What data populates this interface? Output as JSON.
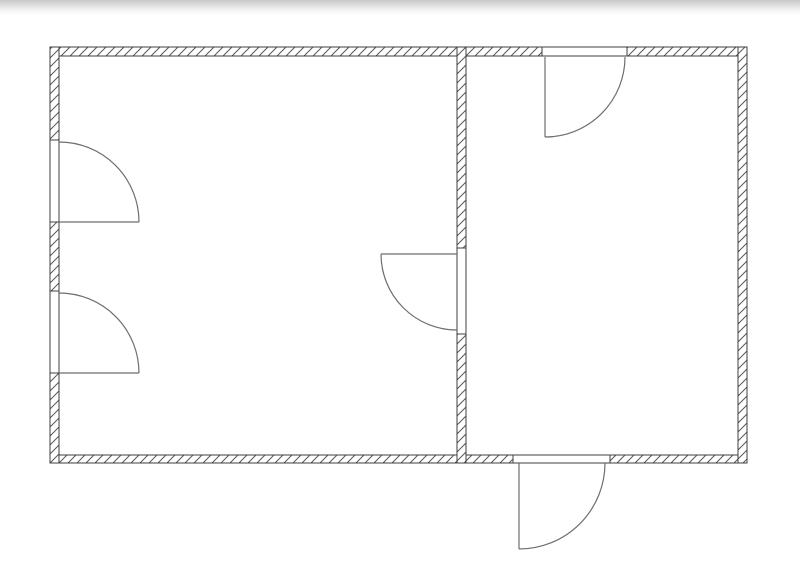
{
  "page": {
    "background": "#ffffff",
    "top_shade": {
      "from": "#c7c7c7",
      "to": "#ffffff",
      "height": 15
    }
  },
  "floorplan": {
    "canvas": {
      "width": 800,
      "height": 574
    },
    "colors": {
      "wall_stroke": "#3f3f3f",
      "hatch_stroke": "#585858",
      "door_stroke": "#6e6e6e",
      "wall_fill": "#ffffff",
      "opening_fill": "#ffffff"
    },
    "hatch": {
      "spacing": 9,
      "stroke_width": 1
    },
    "walls": [
      {
        "name": "wall-top",
        "x": 50,
        "y": 47,
        "w": 697,
        "h": 9
      },
      {
        "name": "wall-bottom",
        "x": 50,
        "y": 455,
        "w": 697,
        "h": 8
      },
      {
        "name": "wall-left",
        "x": 50,
        "y": 47,
        "w": 9,
        "h": 416
      },
      {
        "name": "wall-right",
        "x": 738,
        "y": 47,
        "w": 9,
        "h": 416
      },
      {
        "name": "wall-interior",
        "x": 457,
        "y": 47,
        "w": 9,
        "h": 416
      }
    ],
    "openings": [
      {
        "name": "opening-left-upper",
        "x": 50,
        "y": 140,
        "w": 9,
        "h": 82
      },
      {
        "name": "opening-left-lower",
        "x": 50,
        "y": 291,
        "w": 9,
        "h": 82
      },
      {
        "name": "opening-interior",
        "x": 457,
        "y": 248,
        "w": 9,
        "h": 86
      },
      {
        "name": "opening-top",
        "x": 542,
        "y": 47,
        "w": 85,
        "h": 9
      },
      {
        "name": "opening-bottom",
        "x": 513,
        "y": 455,
        "w": 97,
        "h": 8
      }
    ],
    "doors": [
      {
        "name": "door-left-upper",
        "leaf": {
          "x1": 59,
          "y1": 222,
          "x2": 139,
          "y2": 222
        },
        "arc": {
          "sx": 59,
          "sy": 142,
          "ex": 139,
          "ey": 222,
          "r": 80,
          "sweep": 1
        }
      },
      {
        "name": "door-left-lower",
        "leaf": {
          "x1": 59,
          "y1": 373,
          "x2": 139,
          "y2": 373
        },
        "arc": {
          "sx": 59,
          "sy": 293,
          "ex": 139,
          "ey": 373,
          "r": 80,
          "sweep": 1
        }
      },
      {
        "name": "door-interior-wall",
        "leaf": {
          "x1": 457,
          "y1": 254,
          "x2": 381,
          "y2": 254
        },
        "arc": {
          "sx": 381,
          "sy": 254,
          "ex": 457,
          "ey": 330,
          "r": 76,
          "sweep": 0
        }
      },
      {
        "name": "door-top-right-room",
        "leaf": {
          "x1": 545,
          "y1": 57,
          "x2": 545,
          "y2": 137
        },
        "arc": {
          "sx": 545,
          "sy": 137,
          "ex": 625,
          "ey": 57,
          "r": 80,
          "sweep": 0
        }
      },
      {
        "name": "door-bottom-exterior",
        "leaf": {
          "x1": 519,
          "y1": 463,
          "x2": 519,
          "y2": 549
        },
        "arc": {
          "sx": 519,
          "sy": 549,
          "ex": 605,
          "ey": 463,
          "r": 86,
          "sweep": 0
        }
      }
    ]
  }
}
